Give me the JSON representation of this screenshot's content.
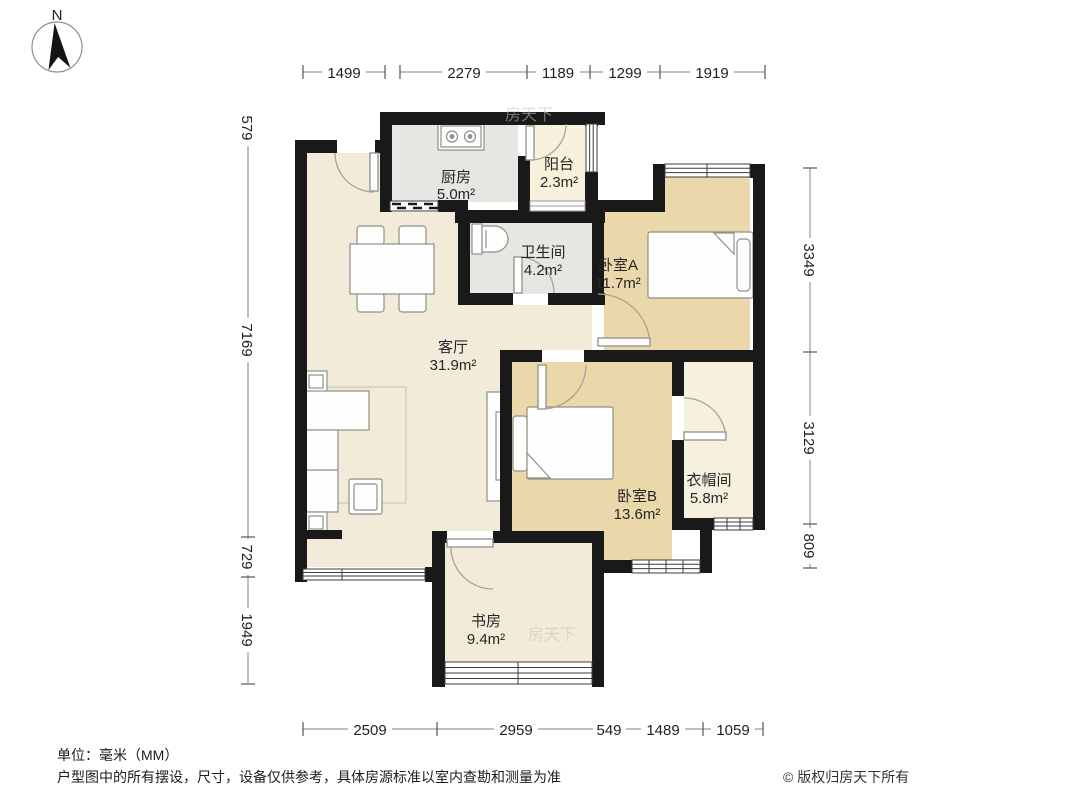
{
  "compass": {
    "north_label": "N"
  },
  "rooms": [
    {
      "name": "厨房",
      "area": "5.0m²"
    },
    {
      "name": "阳台",
      "area": "2.3m²"
    },
    {
      "name": "卫生间",
      "area": "4.2m²"
    },
    {
      "name": "卧室A",
      "area": "11.7m²"
    },
    {
      "name": "客厅",
      "area": "31.9m²"
    },
    {
      "name": "卧室B",
      "area": "13.6m²"
    },
    {
      "name": "衣帽间",
      "area": "5.8m²"
    },
    {
      "name": "书房",
      "area": "9.4m²"
    }
  ],
  "dimensions": {
    "top": [
      "1499",
      "2279",
      "1189",
      "1299",
      "1919"
    ],
    "bottom": [
      "2509",
      "2959",
      "549",
      "1489",
      "1059"
    ],
    "left": [
      "579",
      "7169",
      "729",
      "1949"
    ],
    "right": [
      "3349",
      "3129",
      "809"
    ]
  },
  "watermark": "房天下",
  "footer": {
    "units": "单位：毫米（MM）",
    "disclaimer": "户型图中的所有摆设，尺寸，设备仅供参考，具体房源标准以室内查勘和测量为准",
    "copyright": "© 版权归房天下所有"
  },
  "colors": {
    "wall": "#191919",
    "cream": "#f2ebda",
    "tan": "#ead7aa",
    "gray": "#e7e6e3",
    "light_cream": "#f6f0dc"
  }
}
